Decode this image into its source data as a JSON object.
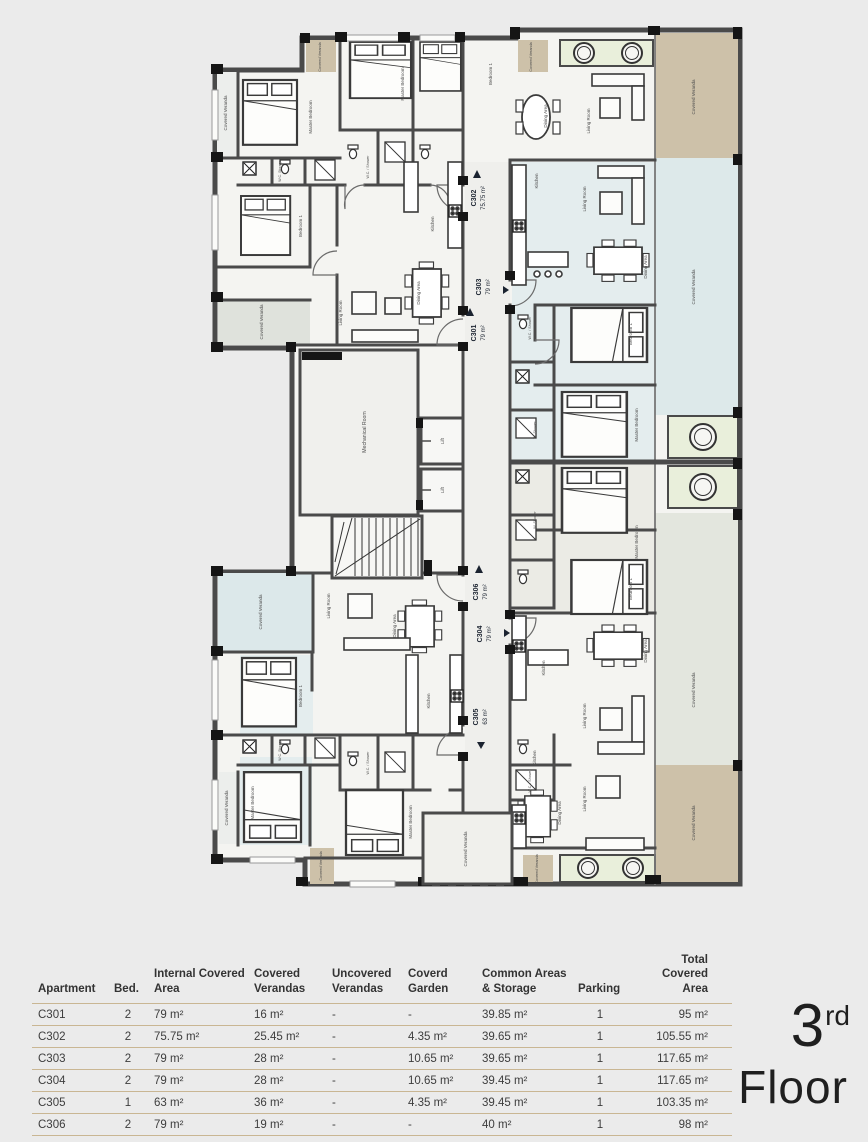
{
  "floor_label": {
    "number": "3",
    "ordinal": "rd",
    "word": "Floor"
  },
  "plan": {
    "rooms": {
      "covered_veranda": "Covered Veranda",
      "master_bedroom": "Master Bedroom",
      "bedroom_1": "Bedroom 1",
      "living_room": "Living Room",
      "dining_area": "Dining Area",
      "kitchen": "Kitchen",
      "wc_shower": "W.C. / Shower",
      "w_shower": "W. Shower",
      "wc_storage": "W.C. Storage",
      "mechanical_room": "Mechanical Room",
      "lift": "Lift"
    },
    "tags": {
      "c301": {
        "code": "C301",
        "area": "79 m²"
      },
      "c302": {
        "code": "C302",
        "area": "75.75 m²"
      },
      "c303": {
        "code": "C303",
        "area": "79 m²"
      },
      "c304": {
        "code": "C304",
        "area": "79 m²"
      },
      "c305": {
        "code": "C305",
        "area": "63 m²"
      },
      "c306": {
        "code": "C306",
        "area": "79 m²"
      }
    }
  },
  "table": {
    "headers": [
      "Apartment",
      "Bed.",
      "Internal Covered Area",
      "Covered Verandas",
      "Uncovered Verandas",
      "Coverd Garden",
      "Common Areas & Storage",
      "Parking",
      "Total Covered Area"
    ],
    "rows": [
      [
        "C301",
        "2",
        "79 m²",
        "16 m²",
        "-",
        "-",
        "39.85 m²",
        "1",
        "95 m²"
      ],
      [
        "C302",
        "2",
        "75.75 m²",
        "25.45 m²",
        "-",
        "4.35 m²",
        "39.65 m²",
        "1",
        "105.55 m²"
      ],
      [
        "C303",
        "2",
        "79 m²",
        "28 m²",
        "-",
        "10.65 m²",
        "39.65 m²",
        "1",
        "117.65 m²"
      ],
      [
        "C304",
        "2",
        "79 m²",
        "28 m²",
        "-",
        "10.65 m²",
        "39.45 m²",
        "1",
        "117.65 m²"
      ],
      [
        "C305",
        "1",
        "63 m²",
        "36 m²",
        "-",
        "4.35 m²",
        "39.45 m²",
        "1",
        "103.35 m²"
      ],
      [
        "C306",
        "2",
        "79 m²",
        "19 m²",
        "-",
        "-",
        "40 m²",
        "1",
        "98 m²"
      ]
    ]
  },
  "colors": {
    "background": "#ebebeb",
    "wall": "#4a4a4a",
    "veranda_tan": "#cdc1a9",
    "veranda_blue": "#dde9ea",
    "veranda_gray": "#e3e6de",
    "jacuzzi_green": "#e9efdb",
    "table_line": "#c9b693"
  }
}
